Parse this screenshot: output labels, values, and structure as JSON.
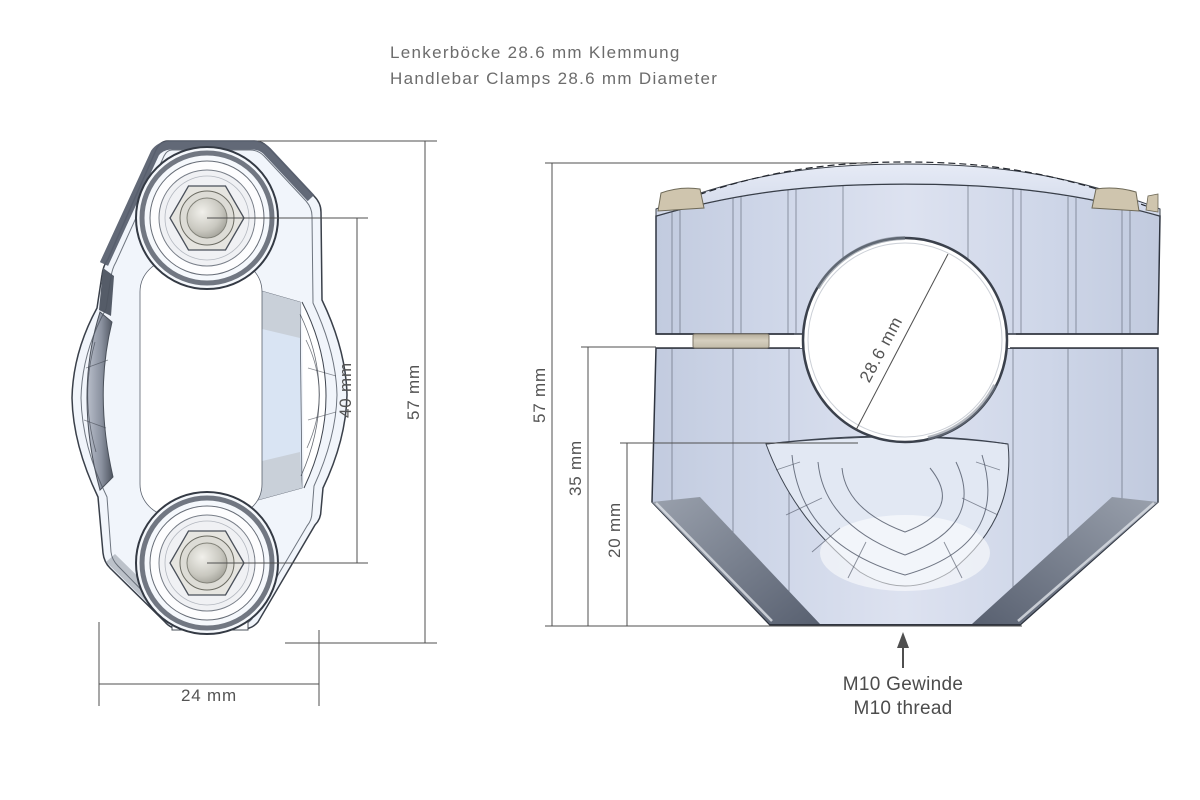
{
  "title": {
    "line1": "Lenkerböcke 28.6 mm Klemmung",
    "line2": "Handlebar Clamps 28.6 mm Diameter"
  },
  "top_view": {
    "dim_bolt_spacing": "40 mm",
    "dim_height": "57 mm",
    "dim_width": "24 mm"
  },
  "front_view": {
    "dim_height": "57 mm",
    "dim_mid": "35 mm",
    "dim_lower": "20 mm",
    "dim_bore": "28.6 mm",
    "note1": "M10 Gewinde",
    "note2": "M10 thread"
  },
  "colors": {
    "background": "#ffffff",
    "body_fill": "#ccd4e6",
    "body_highlight": "#dde3f0",
    "edge_line": "#2f3540",
    "chamfer_gray": "#6e7580",
    "bolt_silver": "#c9c8c0",
    "hardware_tan": "#cfc5ae",
    "dimension_line": "#4f4f4f",
    "text_gray": "#6c6c6c"
  }
}
